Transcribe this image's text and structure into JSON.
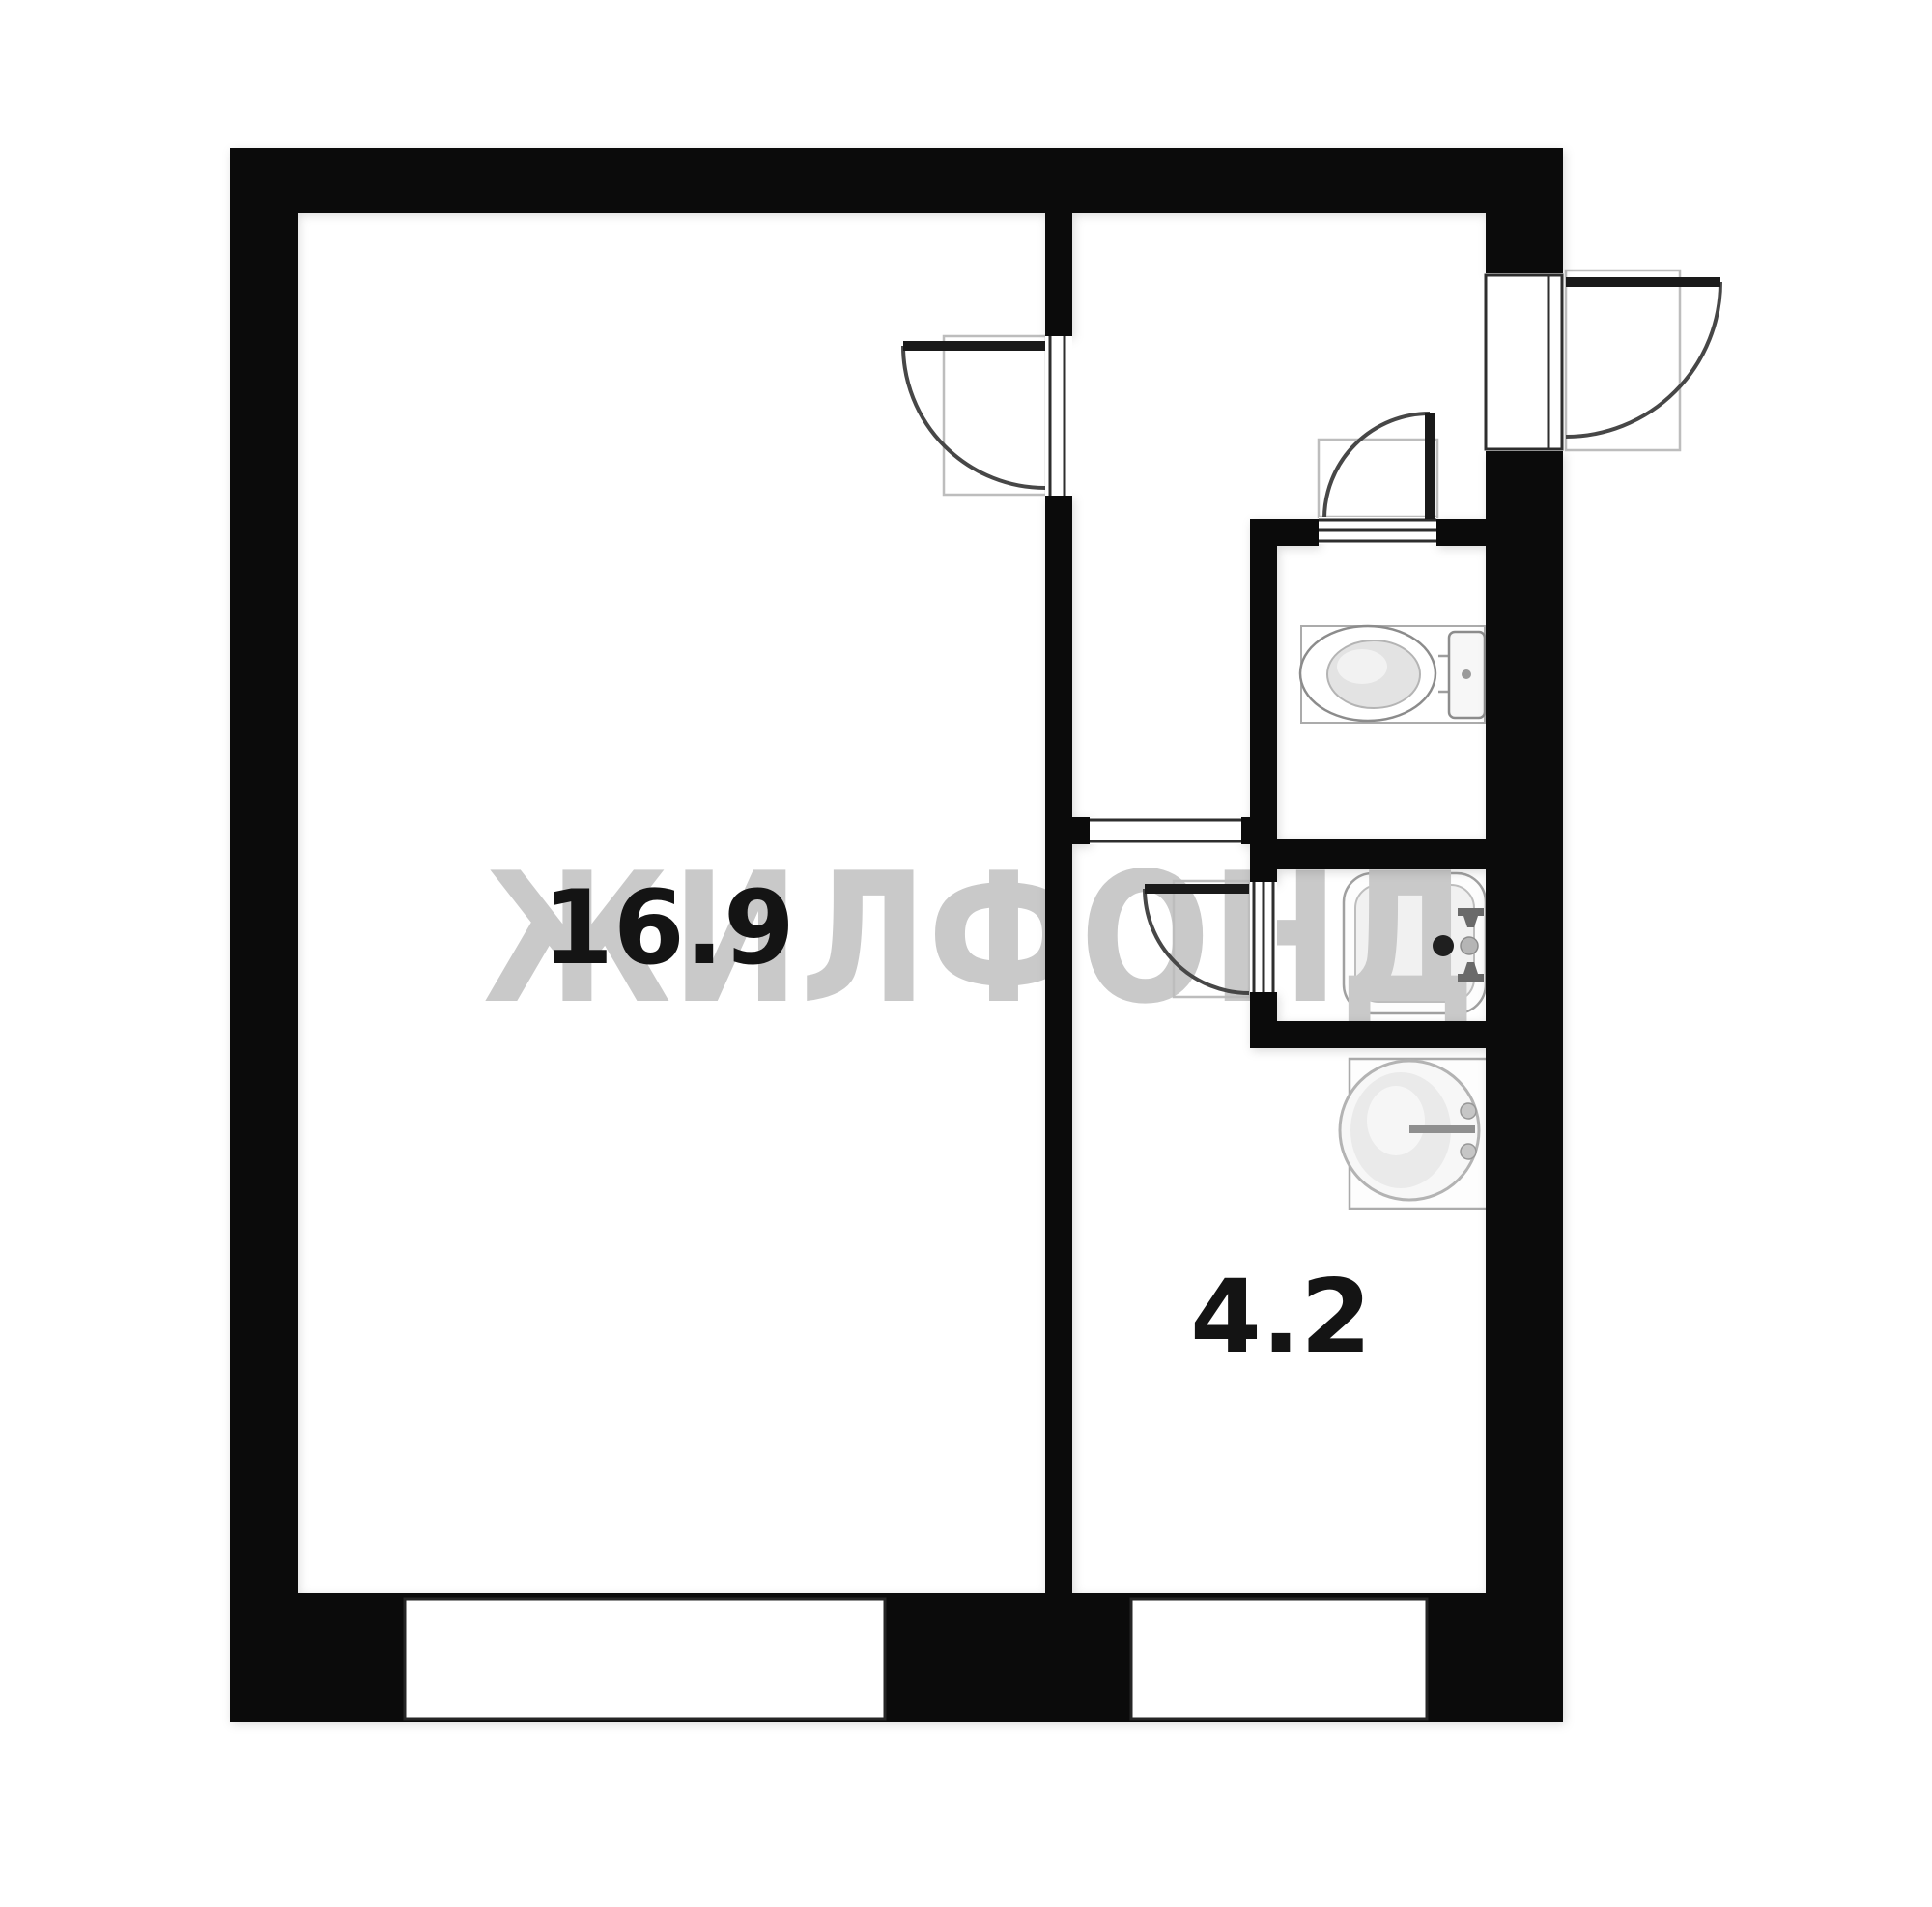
{
  "watermark": {
    "text": "ЖИЛФОНД"
  },
  "rooms": [
    {
      "id": "living-room",
      "area_label": "16.9"
    },
    {
      "id": "kitchen",
      "area_label": "4.2"
    }
  ],
  "doors": [
    {
      "name": "entry-door"
    },
    {
      "name": "living-room-door"
    },
    {
      "name": "wc-door"
    },
    {
      "name": "bathroom-door"
    }
  ],
  "windows": [
    {
      "name": "living-room-window"
    },
    {
      "name": "kitchen-window"
    }
  ],
  "fixtures": [
    {
      "name": "toilet"
    },
    {
      "name": "washbasin"
    },
    {
      "name": "kitchen-sink"
    }
  ],
  "theme": {
    "wall_color": "#0b0b0b",
    "floor_color": "#ffffff",
    "label_color": "#141414",
    "watermark_color": "#c9c9c9",
    "door_line_color": "#474747",
    "leaf_color": "#1a1a1a",
    "swing_box_color": "#bdbdbd",
    "threshold_line_color": "#2e2e2e",
    "window_border_color": "#262626",
    "fixture_stroke": "#9e9e9e"
  }
}
